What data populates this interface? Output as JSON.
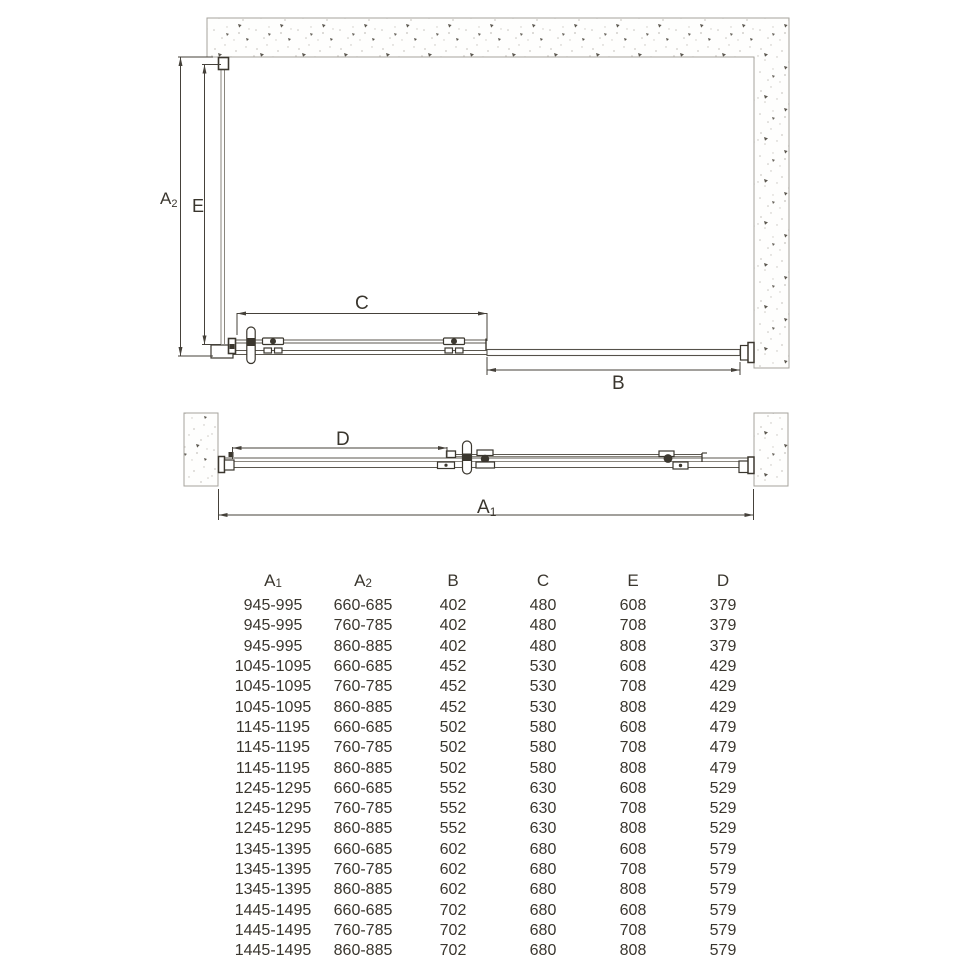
{
  "drawing": {
    "labels": {
      "a2": {
        "base": "A",
        "sub": "2"
      },
      "e": {
        "base": "E",
        "sub": ""
      },
      "c": {
        "base": "C",
        "sub": ""
      },
      "b": {
        "base": "B",
        "sub": ""
      },
      "d": {
        "base": "D",
        "sub": ""
      },
      "a1": {
        "base": "A",
        "sub": "1"
      }
    }
  },
  "table": {
    "headers": [
      {
        "base": "A",
        "sub": "1"
      },
      {
        "base": "A",
        "sub": "2"
      },
      {
        "base": "B",
        "sub": ""
      },
      {
        "base": "C",
        "sub": ""
      },
      {
        "base": "E",
        "sub": ""
      },
      {
        "base": "D",
        "sub": ""
      }
    ],
    "rows": [
      [
        "945-995",
        "660-685",
        "402",
        "480",
        "608",
        "379"
      ],
      [
        "945-995",
        "760-785",
        "402",
        "480",
        "708",
        "379"
      ],
      [
        "945-995",
        "860-885",
        "402",
        "480",
        "808",
        "379"
      ],
      [
        "1045-1095",
        "660-685",
        "452",
        "530",
        "608",
        "429"
      ],
      [
        "1045-1095",
        "760-785",
        "452",
        "530",
        "708",
        "429"
      ],
      [
        "1045-1095",
        "860-885",
        "452",
        "530",
        "808",
        "429"
      ],
      [
        "1145-1195",
        "660-685",
        "502",
        "580",
        "608",
        "479"
      ],
      [
        "1145-1195",
        "760-785",
        "502",
        "580",
        "708",
        "479"
      ],
      [
        "1145-1195",
        "860-885",
        "502",
        "580",
        "808",
        "479"
      ],
      [
        "1245-1295",
        "660-685",
        "552",
        "630",
        "608",
        "529"
      ],
      [
        "1245-1295",
        "760-785",
        "552",
        "630",
        "708",
        "529"
      ],
      [
        "1245-1295",
        "860-885",
        "552",
        "630",
        "808",
        "529"
      ],
      [
        "1345-1395",
        "660-685",
        "602",
        "680",
        "608",
        "579"
      ],
      [
        "1345-1395",
        "760-785",
        "602",
        "680",
        "708",
        "579"
      ],
      [
        "1345-1395",
        "860-885",
        "602",
        "680",
        "808",
        "579"
      ],
      [
        "1445-1495",
        "660-685",
        "702",
        "680",
        "608",
        "579"
      ],
      [
        "1445-1495",
        "760-785",
        "702",
        "680",
        "708",
        "579"
      ],
      [
        "1445-1495",
        "860-885",
        "702",
        "680",
        "808",
        "579"
      ]
    ]
  }
}
